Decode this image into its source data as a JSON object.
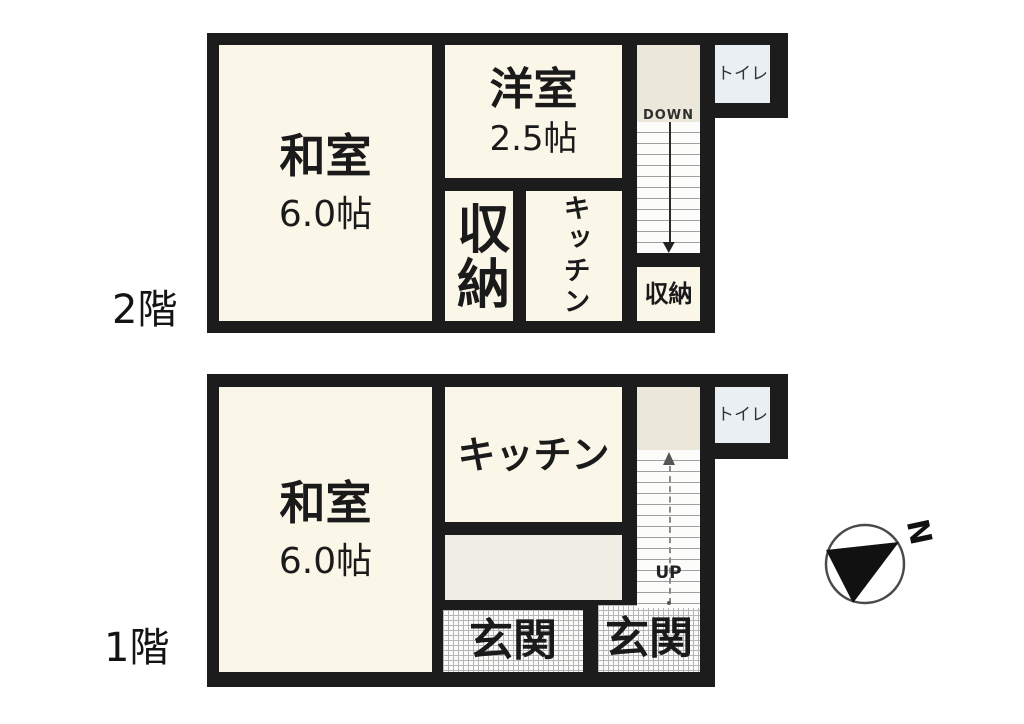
{
  "floor2": {
    "floor_label": "2階",
    "washitsu": {
      "name": "和室",
      "size": "6.0帖"
    },
    "yoshitsu": {
      "name": "洋室",
      "size": "2.5帖"
    },
    "closet_mid": "収納",
    "kitchen": "キッチン",
    "closet_stairs": "収納",
    "toilet": "トイレ",
    "stairs_label": "DOWN"
  },
  "floor1": {
    "floor_label": "1階",
    "washitsu": {
      "name": "和室",
      "size": "6.0帖"
    },
    "kitchen": "キッチン",
    "genkan_left": "玄関",
    "genkan_right": "玄関",
    "toilet": "トイレ",
    "stairs_label": "UP"
  },
  "compass": {
    "north_label": "N"
  },
  "colors": {
    "wall": "#1c1c1c",
    "room_cream": "#faf6e8",
    "landing_beige": "#ebe7da",
    "store_gray": "#f0ede4",
    "toilet_blue": "#eaeff4",
    "tread_line": "#a0a0a0",
    "hatch_line": "#b5b5b5",
    "background": "#ffffff"
  }
}
